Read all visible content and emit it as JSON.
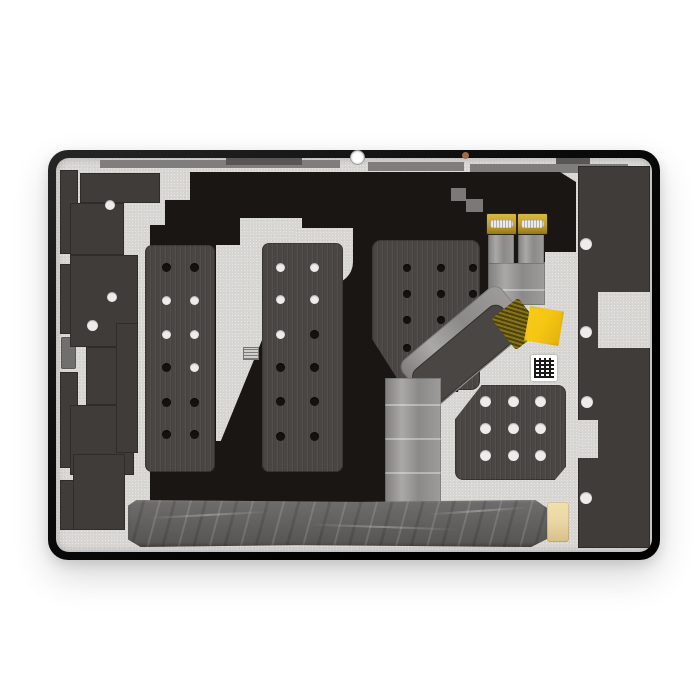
{
  "photo": {
    "subject": "Tablet LCD display assembly, rear view, studio product photo on white background"
  },
  "colors": {
    "frame": "#0d0d0d",
    "panel": "#d8d6d3",
    "shield": "#191613",
    "graphite": "#3f3c39",
    "foam": "#4a4643",
    "ribbon": "#999896",
    "gold": "#c2a02c",
    "kapton": "#f5c513",
    "tape": "#615f5e",
    "tan": "#e9d6a4",
    "copper": "#a06c48",
    "trim": "#807e7c",
    "holew": "#edecea",
    "holed": "#14120f"
  },
  "parts": {
    "frame": "black display frame with rounded corners",
    "back_panel": "silver metal back plate",
    "emi_shield": "black shield film covering center",
    "left_bracket": "left graphite adhesive bracket with through-holes",
    "right_strip": "right graphite adhesive strip with through-holes",
    "foam_pads": [
      "foam pad 1 (2x6 holes)",
      "foam pad 2 (2x6 holes)",
      "foam pad 3 (3x4 holes)",
      "foam pad 4 (3x3 holes)"
    ],
    "flex_cable": "wide display flex cable, folded, routed to bottom",
    "flex_connectors": [
      "board connector 1 (gold)",
      "board connector 2 (gold)"
    ],
    "gold_mesh_section": "woven gold section of flex cable",
    "kapton_tape": "yellow kapton tape square",
    "qr_sticker": "white QR code sticker",
    "micro_label": "tiny printed label sticker",
    "bottom_tape": "wrinkled dark gray tape strip along bottom",
    "tan_pad": "tan adhesive pad at right end of tape",
    "camera_opening": "white front camera opening on top edge",
    "copper_dot": "small copper contact dot on top edge"
  }
}
